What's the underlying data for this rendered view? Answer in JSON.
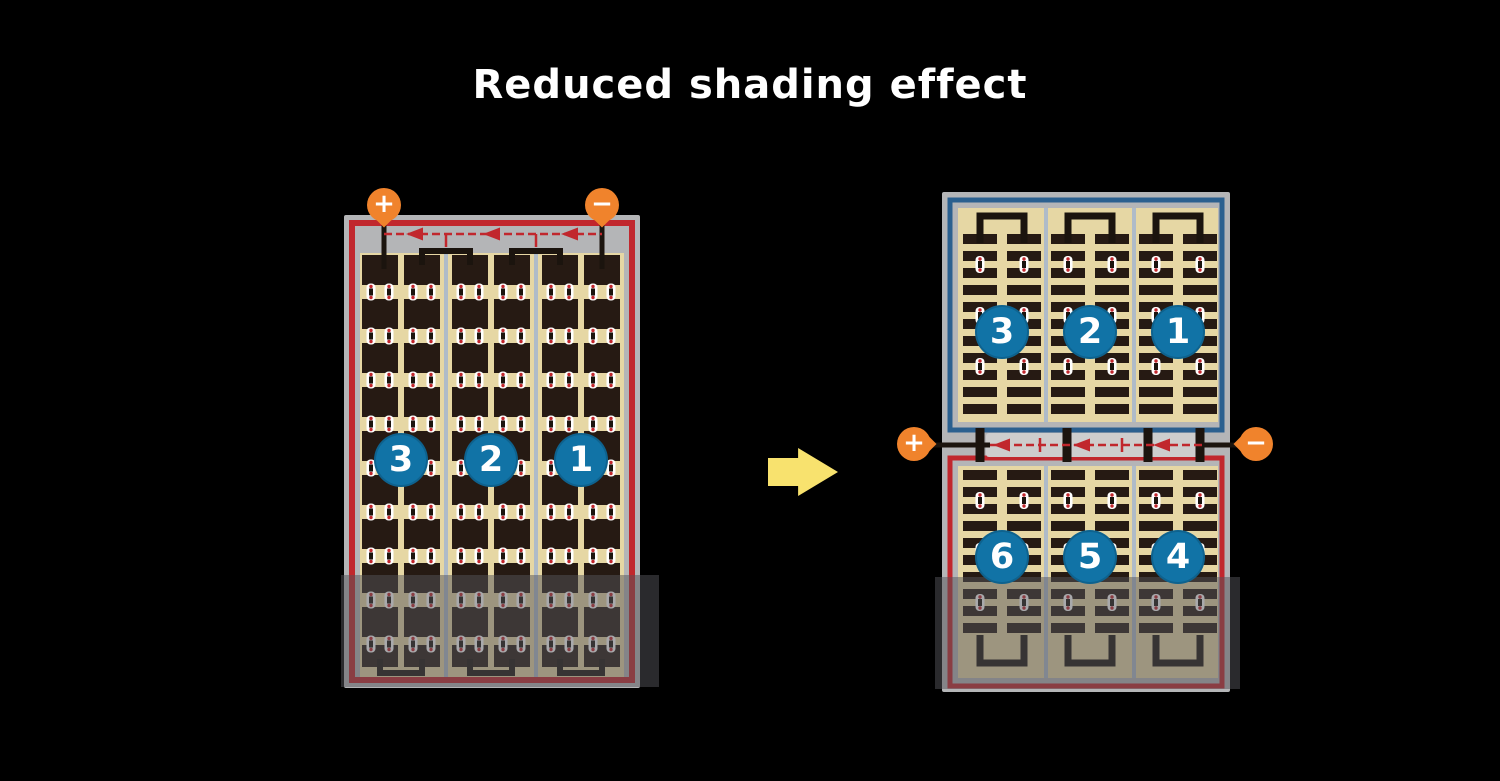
{
  "title": "Reduced shading effect",
  "left_panel": {
    "terminal_positive": "+",
    "terminal_negative": "−",
    "string_labels": [
      "3",
      "2",
      "1"
    ]
  },
  "right_panel": {
    "terminal_positive": "+",
    "terminal_negative": "−",
    "top_string_labels": [
      "3",
      "2",
      "1"
    ],
    "bottom_string_labels": [
      "6",
      "5",
      "4"
    ]
  },
  "colors": {
    "background": "#000000",
    "title_text": "#FFFFFF",
    "frame": "#B4B5B7",
    "cell_bg_tan": "#E6D7A4",
    "cell_dark": "#261A13",
    "divider": "#AFBBC8",
    "circuit_red": "#C1272D",
    "circuit_blue": "#2B608F",
    "wire_black": "#1B140E",
    "badge_bg": "#1173A6",
    "badge_text": "#FFFFFF",
    "terminal_bg": "#F0832C",
    "terminal_text": "#FFFFFF",
    "pill_white": "#FFFFFF",
    "junction_plate": "#CDCDCD",
    "shading_overlay": "rgba(84,84,90,0.5)",
    "arrow_yellow": "#F8E26E"
  }
}
